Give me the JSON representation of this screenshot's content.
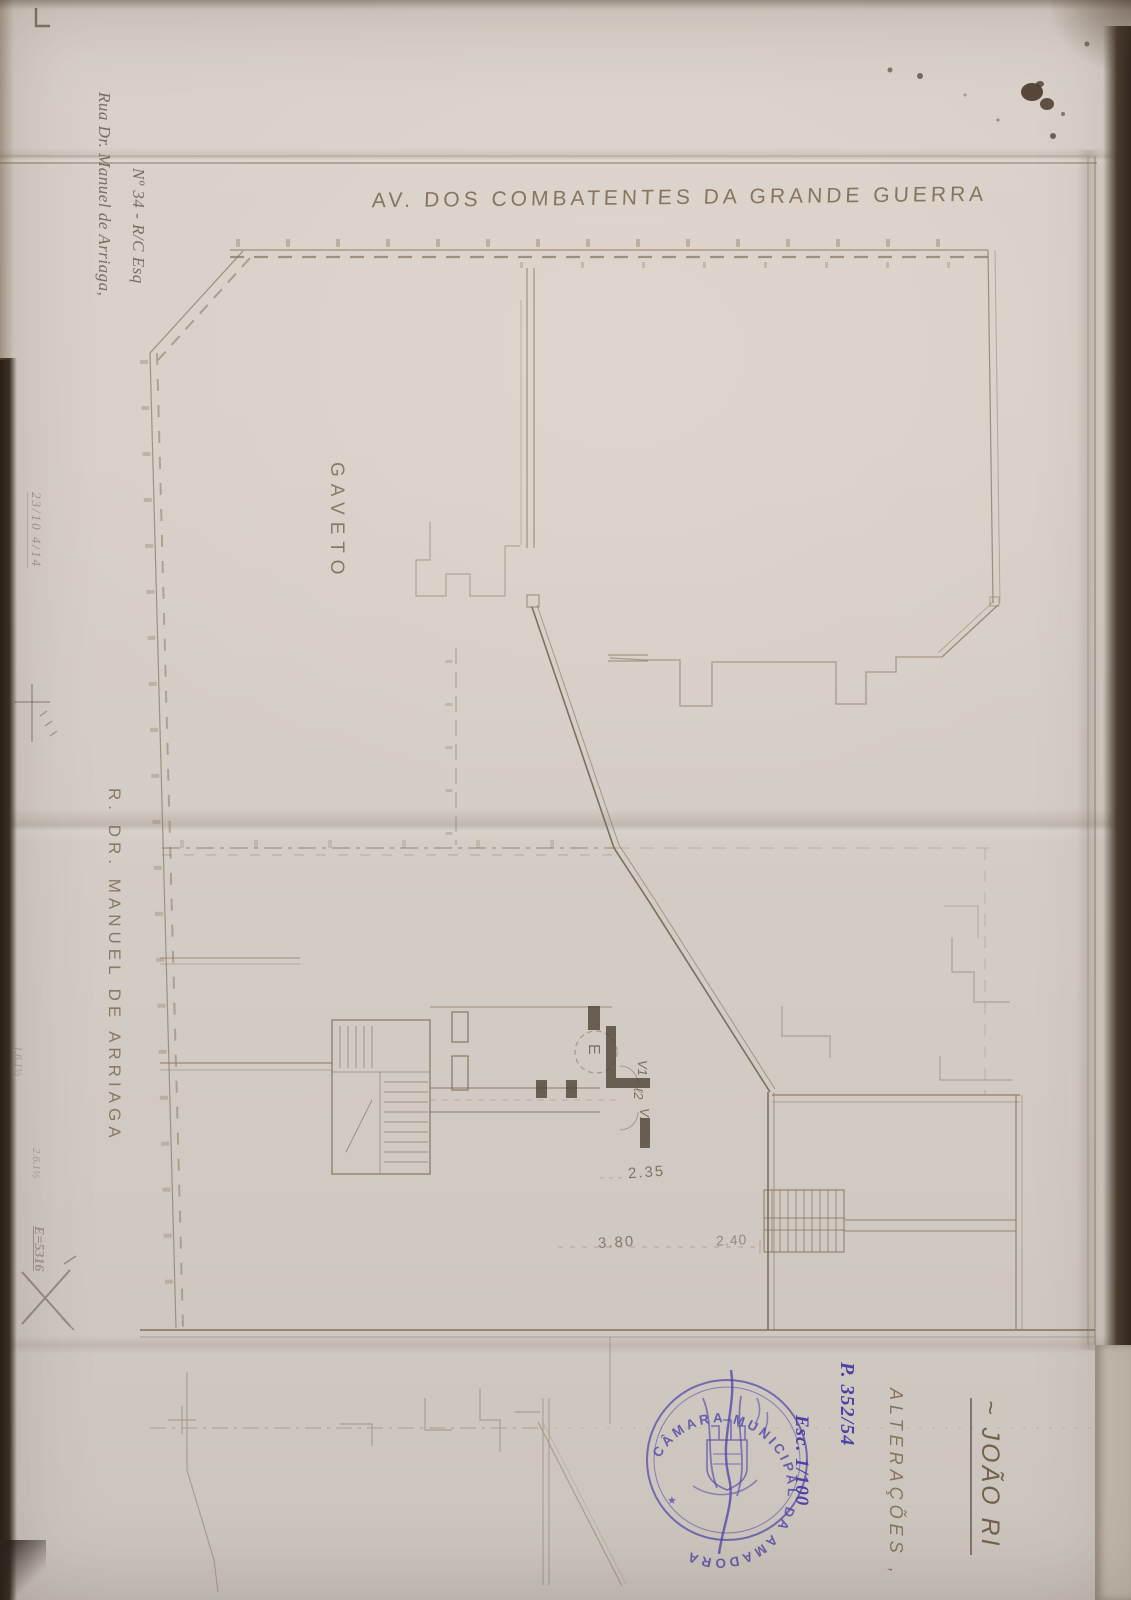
{
  "page": {
    "street_top_label": "AV. DOS COMBATENTES DA GRANDE GUERRA",
    "street_left_label": "R. DR. MANUEL DE ARRIAGA",
    "corner_label": "GAVETO",
    "address_line1": "Rua Dr. Manuel de Arriaga,",
    "address_line2": "Nº 34 - R/C Esq",
    "title_name": "~ JOÃO RI",
    "alteracoes_label": "ALTERAÇÕES ,",
    "process_note": "P. 352/54",
    "scale_note": "Esc. 1/100",
    "dim_235": "2.35",
    "dim_380": "3.80",
    "dim_240": "2.40",
    "entry_label": "E",
    "door_label_v1a": "V1",
    "door_label_l2": "ℓ2",
    "door_label_v1b": "V1",
    "pencil_note_date": "23/10 4/14",
    "pencil_note_a": "1.6.1½",
    "pencil_note_b": "2.6.1½",
    "pencil_note_c": "E=5316"
  },
  "stamp": {
    "ring_text": "CÂMARA MUNICIPAL DA AMADORA",
    "star": "★",
    "ink_color": "#4c42a6"
  },
  "colors": {
    "paper": "#d7cfc7",
    "pencil": "#8d7c67",
    "pencil_dark": "#5a4c3d",
    "ink_blue": "#4c42a6",
    "stain_brown": "#4a3a2c"
  }
}
